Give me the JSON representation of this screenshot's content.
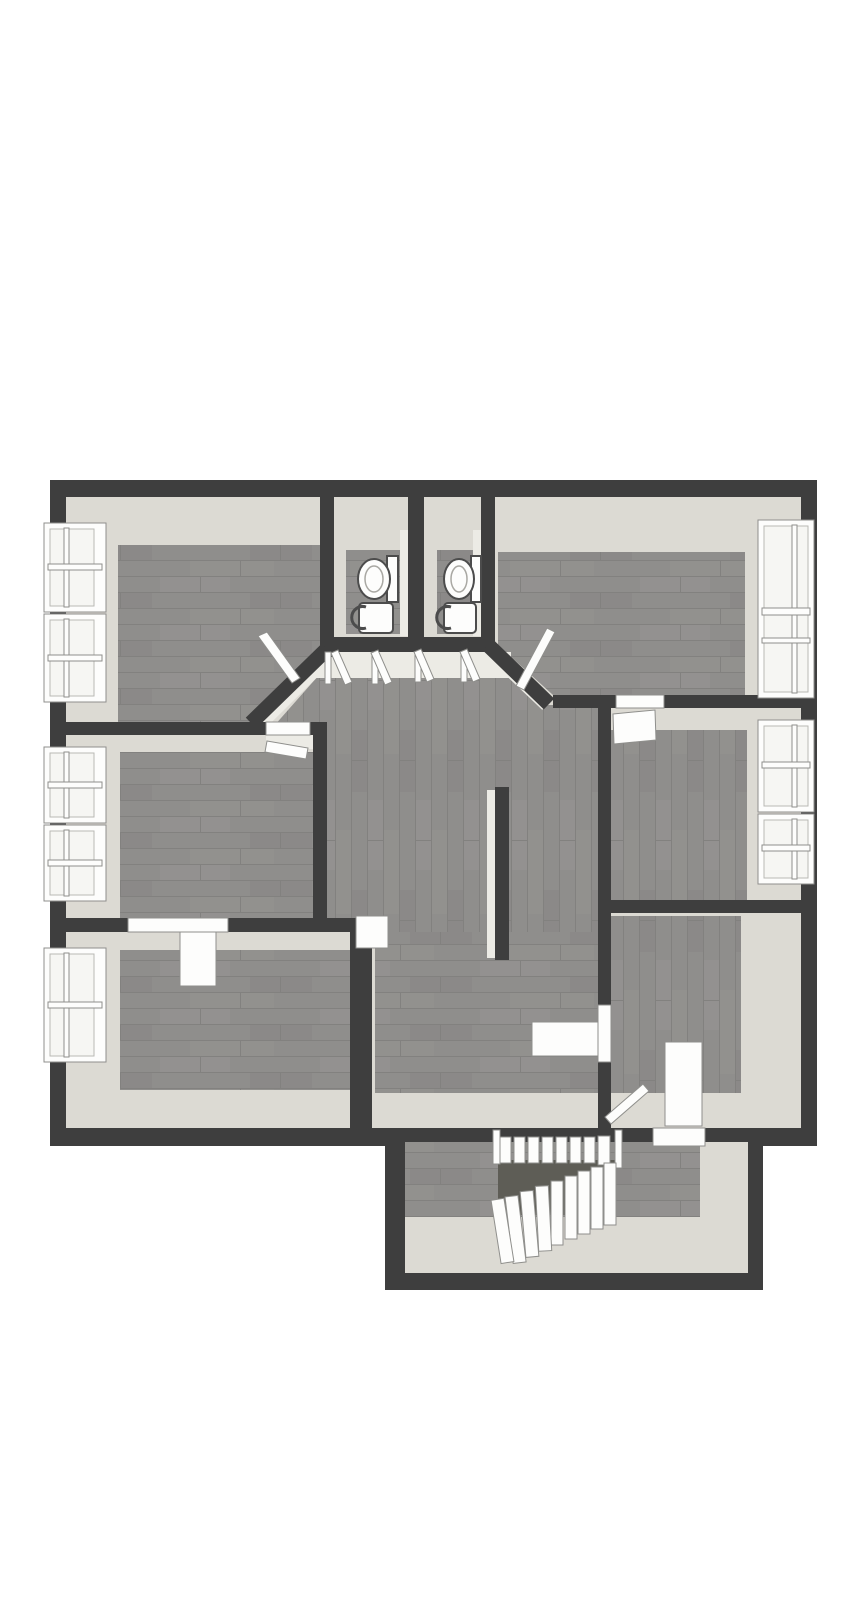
{
  "scene": {
    "description": "3D top-down dollhouse rendering of an upper-floor apartment floor plan on a white background",
    "background": "#ffffff",
    "visible_text": []
  },
  "palette": {
    "wall": "#3e3e3e",
    "face": "#dcdad3",
    "face2": "#ecebe5",
    "wood": "#8f8e8c",
    "woodline": "#82817f",
    "woodhi": "#9b9a98",
    "hole": "#5e5d56",
    "white": "#fdfdfc",
    "outline": "#8f8f8c",
    "glass": "#f6f6f3",
    "fixline": "#4c4c4c"
  },
  "rooms": [
    {
      "name": "bedroom-top-left",
      "floor": "grey-wood",
      "windows": 2,
      "doors": 1,
      "door_type": "angled-corner-door"
    },
    {
      "name": "wc-left",
      "floor": "grey-wood",
      "fixtures": [
        "toilet",
        "sink"
      ],
      "doors": 1
    },
    {
      "name": "wc-right",
      "floor": "grey-wood",
      "fixtures": [
        "toilet",
        "sink"
      ],
      "doors": 1
    },
    {
      "name": "bedroom-top-right",
      "floor": "grey-wood",
      "windows": 1,
      "doors": 1,
      "door_type": "angled-corner-door"
    },
    {
      "name": "bedroom-middle-left",
      "floor": "grey-wood",
      "windows": 2,
      "doors": 1
    },
    {
      "name": "bedroom-middle-right",
      "floor": "grey-wood",
      "windows": 2,
      "doors": 1
    },
    {
      "name": "bedroom-bottom-left",
      "floor": "grey-wood",
      "windows": 1,
      "doors": 1
    },
    {
      "name": "room-bottom-right",
      "floor": "grey-wood",
      "windows": 0,
      "doors": 2
    },
    {
      "name": "hallway-landing",
      "floor": "grey-wood",
      "shape": "chamfered-octagonal-top",
      "connects_all_rooms": true
    },
    {
      "name": "stair-hall-extension",
      "floor": "grey-wood",
      "stairs": {
        "straight_treads": 8,
        "winder_treads": 9,
        "stairwell_opening": true
      }
    }
  ],
  "counts": {
    "windows_total": 8,
    "windows_left_wall": 5,
    "windows_right_wall": 3,
    "toilets": 2,
    "sinks": 2,
    "open_door_leaves": 9,
    "stair_flights": 2
  }
}
